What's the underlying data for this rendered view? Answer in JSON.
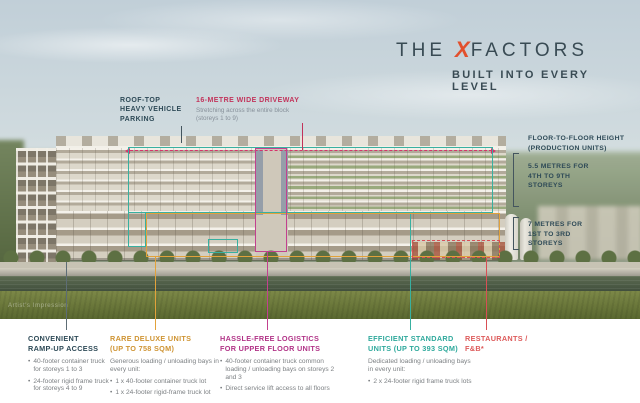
{
  "brand": {
    "title_pre": "THE",
    "title_x": "X",
    "title_rest": "FACTORS",
    "subtitle": "BUILT INTO EVERY LEVEL"
  },
  "callouts": {
    "rooftop": {
      "line1": "ROOF-TOP",
      "line2": "HEAVY VEHICLE",
      "line3": "PARKING"
    },
    "driveway": {
      "title": "16-METRE WIDE DRIVEWAY",
      "desc1": "Stretching across the entire block",
      "desc2": "(storeys 1 to 9)"
    },
    "floor_height": {
      "title1": "FLOOR-TO-FLOOR HEIGHT",
      "title2": "(PRODUCTION UNITS)",
      "upper1": "5.5 METRES FOR",
      "upper2": "4TH TO 9TH",
      "upper3": "STOREYS",
      "lower1": "7 METRES FOR",
      "lower2": "1ST TO 3RD",
      "lower3": "STOREYS"
    }
  },
  "legend": {
    "ramp": {
      "header1": "CONVENIENT",
      "header2": "RAMP-UP ACCESS",
      "bullets": [
        "40-footer container truck for storeys 1 to 3",
        "24-footer rigid frame truck for storeys 4 to 9"
      ]
    },
    "deluxe": {
      "header1": "RARE DELUXE UNITS",
      "header2": "(UP TO 758 SQM)",
      "intro": "Generous loading / unloading bays in every unit:",
      "bullets": [
        "1 x 40-footer container truck lot",
        "1 x 24-footer rigid-frame truck lot"
      ]
    },
    "logistics": {
      "header1": "HASSLE-FREE LOGISTICS",
      "header2": "FOR UPPER FLOOR UNITS",
      "bullets": [
        "40-footer container truck common loading / unloading bays on storeys 2 and 3",
        "Direct service lift access to all floors"
      ]
    },
    "standard": {
      "header1": "EFFICIENT STANDARD",
      "header2": "UNITS (UP TO 393 SQM)",
      "intro": "Dedicated loading / unloading bays in every unit:",
      "bullets": [
        "2 x 24-footer rigid frame truck lots"
      ]
    },
    "restaurants": {
      "header1": "RESTAURANTS /",
      "header2": "F&B*"
    }
  },
  "watermark": "Artist's Impression",
  "colors": {
    "brand_dark": "#394b54",
    "brand_accent": "#e2502d",
    "driveway_red": "#c2335a",
    "teal_outline": "#38b0a0",
    "orange_outline": "#e2a23b",
    "magenta_outline": "#c2418f",
    "red_outline": "#d84f55",
    "deluxe_amber": "#cf9433",
    "logistics_magenta": "#b13387",
    "standard_teal": "#2fa99c",
    "restaurant_red": "#dd5a5a",
    "body_gray": "#7d8184"
  }
}
